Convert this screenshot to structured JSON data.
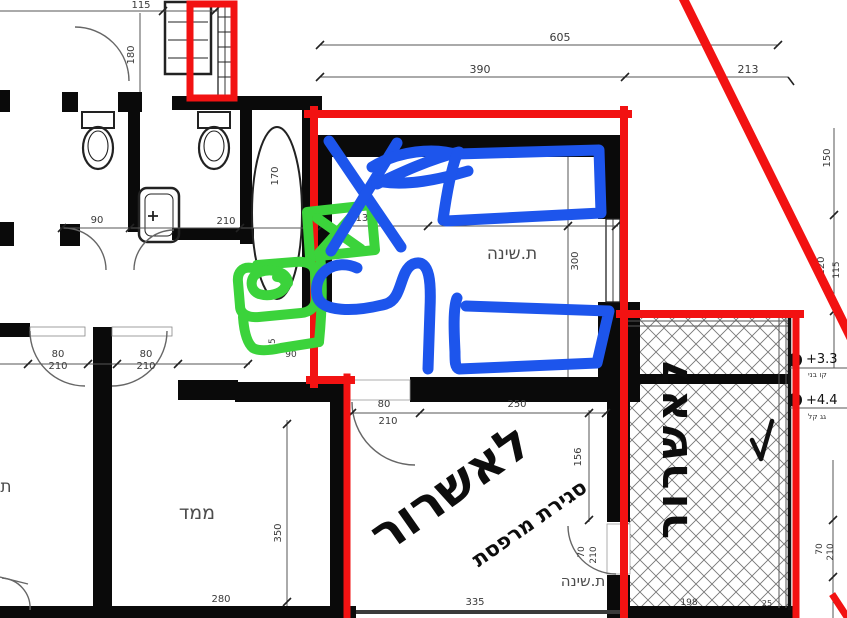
{
  "labels": {
    "bedroom_top": "ת.שינה",
    "bedroom_bottom": "ת.שינה",
    "mamad": "ממד",
    "room_partial": "ת",
    "approval_line1": "לאשרור",
    "approval_line2": "סגירת מרפסת",
    "approval_vertical": "לאשרור"
  },
  "dims": {
    "top_total": "605",
    "top_a": "390",
    "top_b": "213",
    "tl_width": "115",
    "tl_height": "180",
    "right_a": "150",
    "right_b": "120",
    "right_c": "115",
    "bath_a": "90",
    "bath_b": "210",
    "tub": "170",
    "bed_a": "135",
    "bed_b": "250",
    "bed_c": "300",
    "hall_door1_w": "80",
    "hall_door1_h": "210",
    "hall_door2_w": "80",
    "hall_door2_h": "210",
    "small_a": "85",
    "small_b": "90",
    "bed2_door_w": "80",
    "bed2_door_h": "210",
    "bed2_a": "250",
    "bed2_b": "156",
    "bed2_door2_w": "70",
    "bed2_door2_h": "210",
    "mamad_h": "350",
    "mamad_w": "280",
    "bed2_w": "335",
    "hatch_a": "198",
    "hatch_b": "25",
    "out_door_w": "70",
    "out_door_h": "210"
  },
  "elev": {
    "e1": "+3.3",
    "e1_note": "קו בני",
    "e2": "+4.4",
    "e2_note": "גג קל"
  },
  "colors": {
    "markup_red": "#f21212",
    "annotation_blue": "#1d55ec",
    "annotation_green": "#3bd33b",
    "wall_black": "#0a0a0a",
    "dimension_gray": "#555555"
  }
}
